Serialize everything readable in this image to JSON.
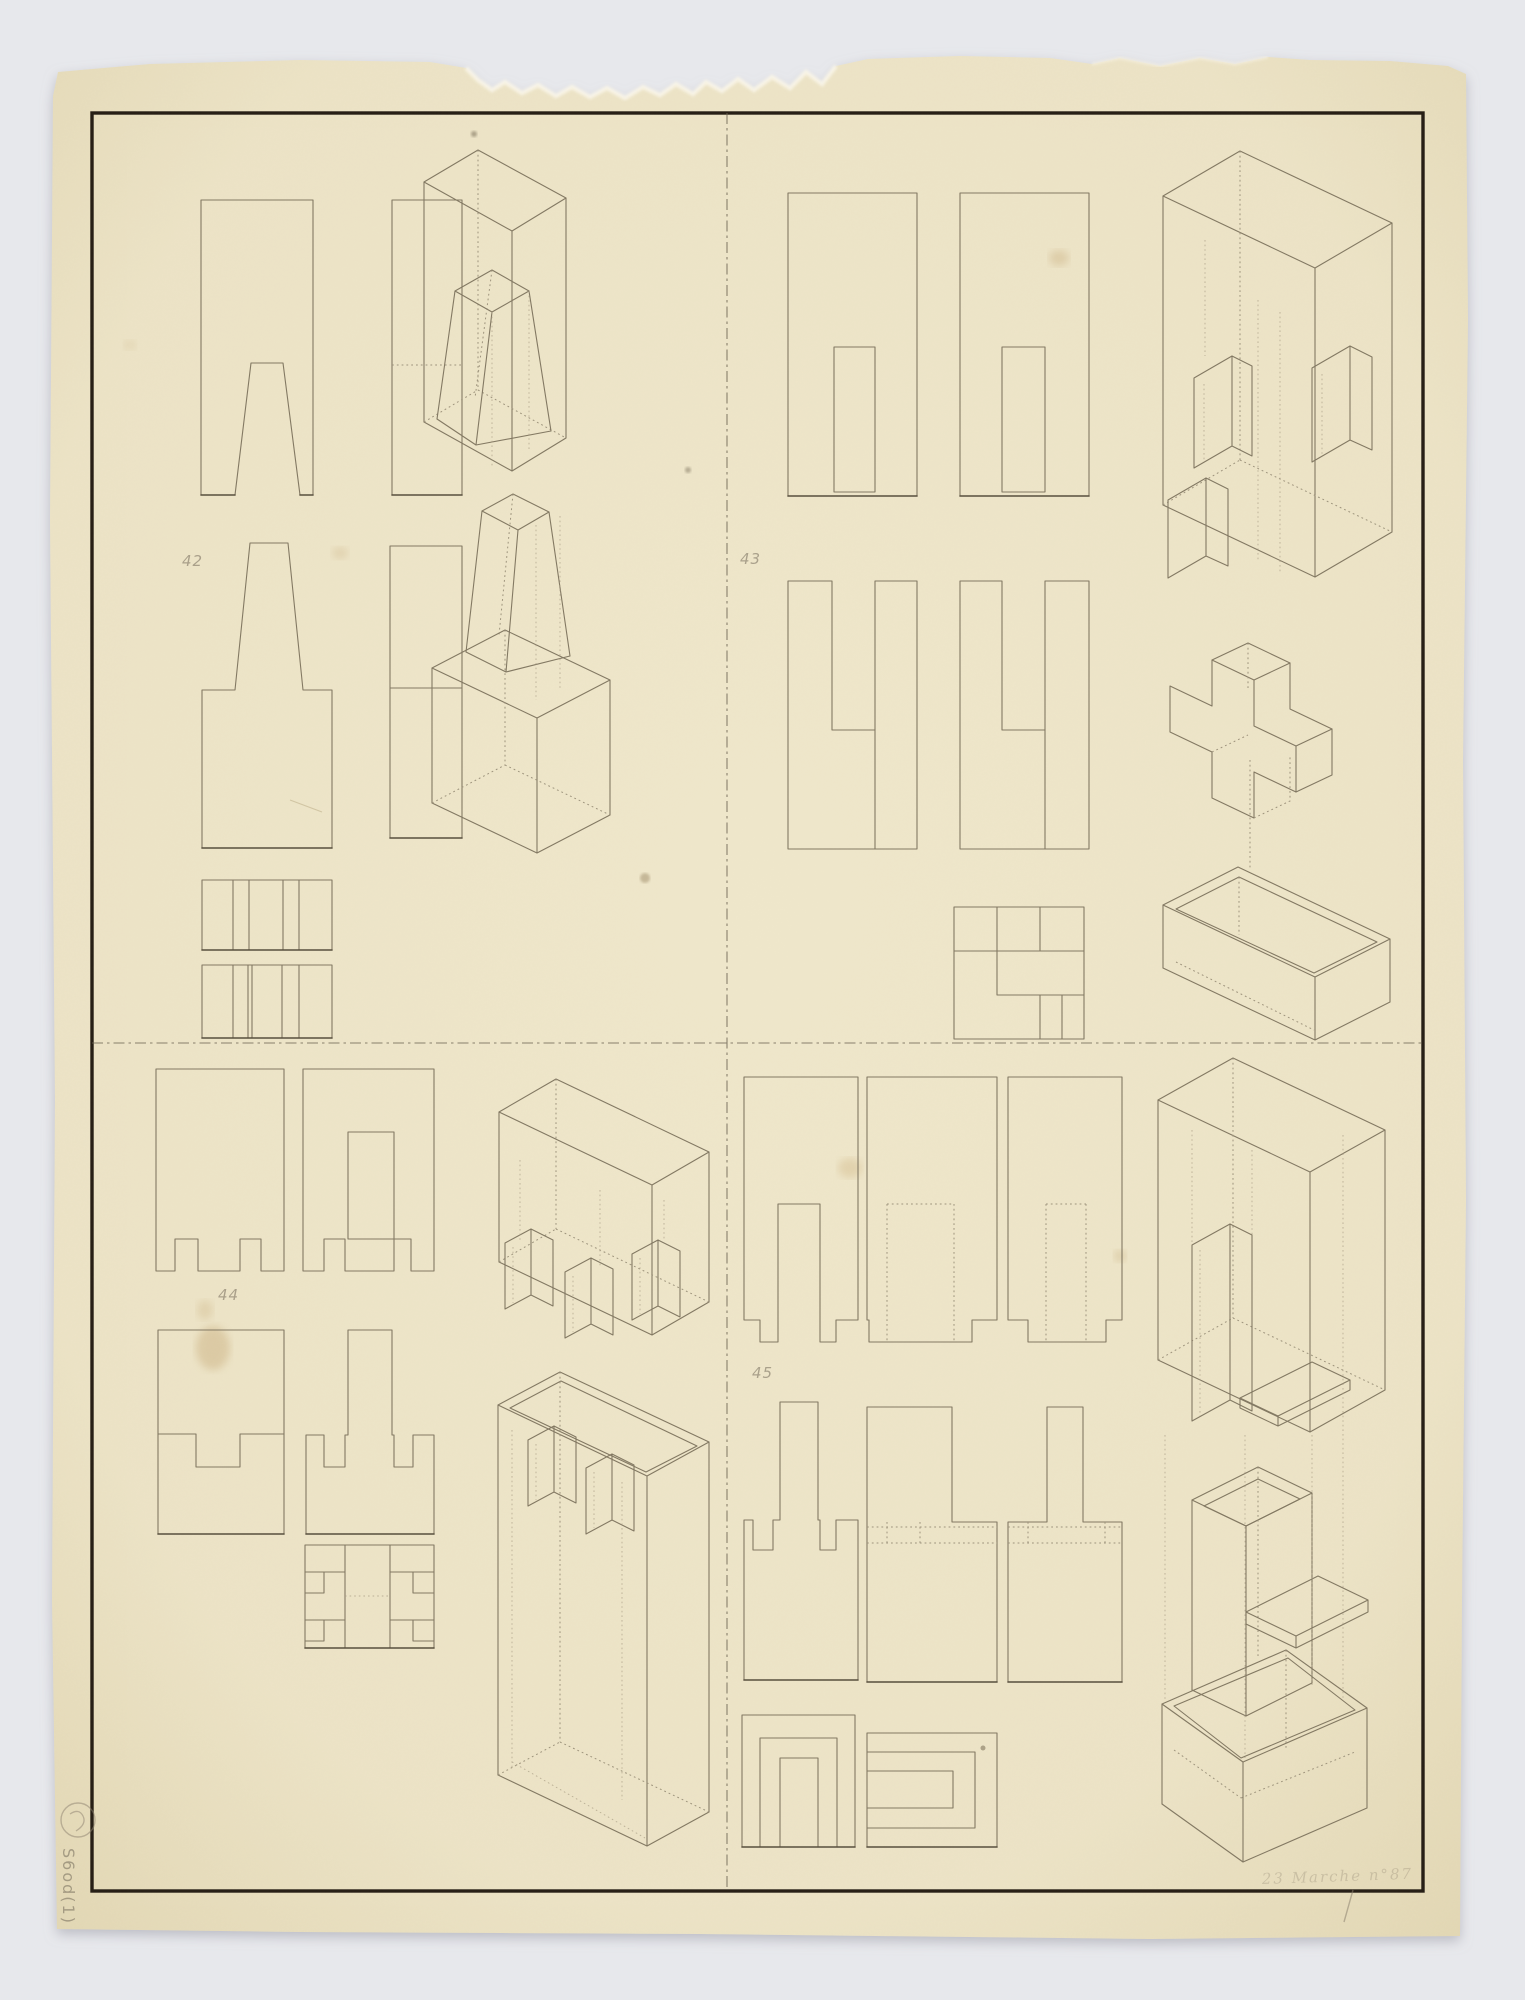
{
  "palette": {
    "background": "#e7e8ec",
    "paper": "#ece3c6",
    "paper_edge_shadow": "#d8cda9",
    "tear_highlight": "#f9f5e8",
    "ink_line": "#837963",
    "ink_dark": "#574e3d",
    "construction_dotted": "#9d937c",
    "border_frame": "#271f16",
    "pencil": "#877d6b"
  },
  "pencil_labels": {
    "q1": "42",
    "q2": "43",
    "q3": "44",
    "q4": "45"
  },
  "annotations": {
    "margin_note_vertical": "S6od(1)",
    "signature": "23 Marche n°87"
  },
  "sheet": {
    "layout": "four quadrants separated by dash-dot centerlines inside a ruled black border",
    "quadrants": [
      {
        "label": "42",
        "content": "front view with trapezoidal bottom notch, side view, chimney-shaped front view, side view, two striped plan strips, two isometric projections"
      },
      {
        "label": "43",
        "content": "two front views with rectangular slots, two views with open top slots, pinwheel plan square, isometric box with interlocking channels, cross prism over open box"
      },
      {
        "label": "44",
        "content": "front view with two bottom notches, view with central tongue, stepped channel view, tee-shaped view, H-pattern plan, two isometric projections with U-channels"
      },
      {
        "label": "45",
        "content": "forked view with feet, two views with hidden slots and bottom tabs, three tee-profile views, nested arch plan, nested C plan, three isometric projections of sleeve and tray joint"
      }
    ]
  }
}
